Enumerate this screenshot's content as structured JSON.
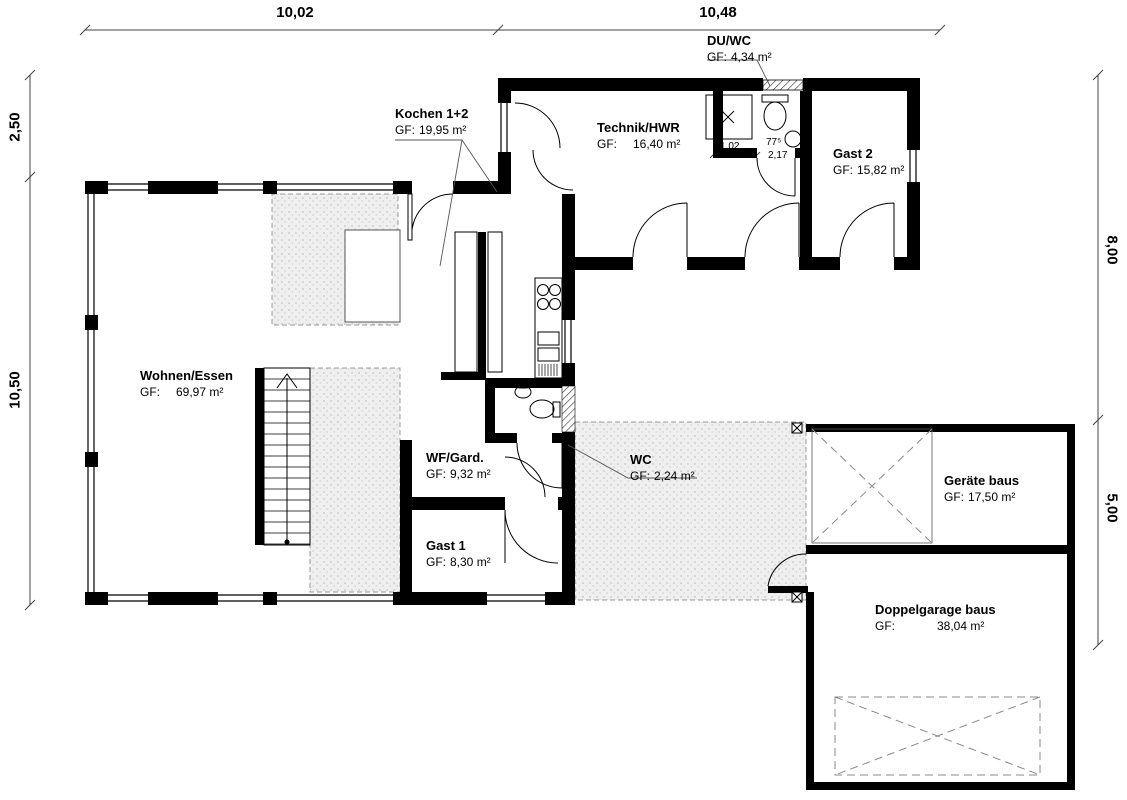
{
  "plan": {
    "type": "floor-plan",
    "rooms": [
      {
        "name": "Wohnen/Essen",
        "gf": "GF:",
        "area": "69,97 m²"
      },
      {
        "name": "Kochen 1+2",
        "gf": "GF:",
        "area": "19,95 m²"
      },
      {
        "name": "Technik/HWR",
        "gf": "GF:",
        "area": "16,40 m²"
      },
      {
        "name": "DU/WC",
        "gf": "GF:",
        "area": "4,34 m²"
      },
      {
        "name": "Gast 2",
        "gf": "GF:",
        "area": "15,82 m²"
      },
      {
        "name": "WF/Gard.",
        "gf": "GF:",
        "area": "9,32 m²"
      },
      {
        "name": "WC",
        "gf": "GF:",
        "area": "2,24 m²"
      },
      {
        "name": "Gast 1",
        "gf": "GF:",
        "area": "8,30 m²"
      },
      {
        "name": "Geräte baus",
        "gf": "GF:",
        "area": "17,50 m²"
      },
      {
        "name": "Doppelgarage baus",
        "gf": "GF:",
        "area": "38,04 m²"
      }
    ],
    "dimensions": {
      "top_left": "10,02",
      "top_right": "10,48",
      "left_upper": "2,50",
      "left_lower": "10,50",
      "right_upper": "8,00",
      "right_lower": "5,00",
      "duwc_width": "1,02",
      "duwc_door_angle": "77⁵",
      "duwc_door": "2,17"
    }
  }
}
